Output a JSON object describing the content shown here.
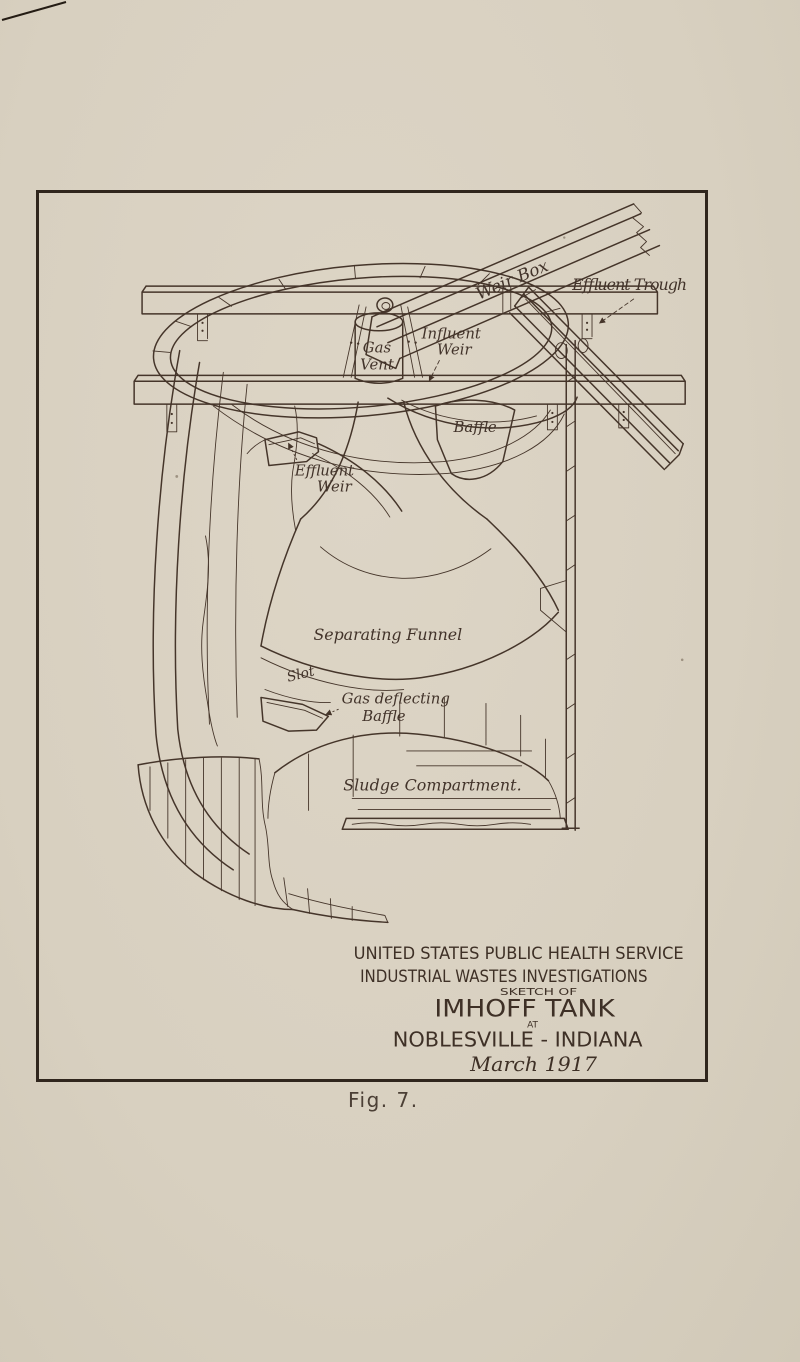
{
  "figure": {
    "caption": "Fig. 7.",
    "drawing_labels": {
      "effluent_trough": "Effluent Trough",
      "weir_box": "Weir Box",
      "gas_vent": {
        "line1": "Gas",
        "line2": "Vent"
      },
      "influent_weir": {
        "line1": "Influent",
        "line2": "Weir"
      },
      "baffle": "Baffle",
      "effluent_weir": {
        "line1": "Effluent",
        "line2": "Weir"
      },
      "separating_funnel": "Separating Funnel",
      "slot": "Slot",
      "gas_deflecting_baffle": {
        "line1": "Gas deflecting",
        "line2": "Baffle"
      },
      "sludge_compartment": "Sludge Compartment."
    },
    "title_block": {
      "organization": "UNITED STATES PUBLIC HEALTH SERVICE",
      "division": "INDUSTRIAL WASTES INVESTIGATIONS",
      "sketch_of": "SKETCH OF",
      "subject": "IMHOFF TANK",
      "at": "AT",
      "location": "NOBLESVILLE - INDIANA",
      "date": "March 1917"
    },
    "colors": {
      "paper": "#d9d1c1",
      "ink": "#45352a",
      "frame_border": "#30261d"
    }
  }
}
